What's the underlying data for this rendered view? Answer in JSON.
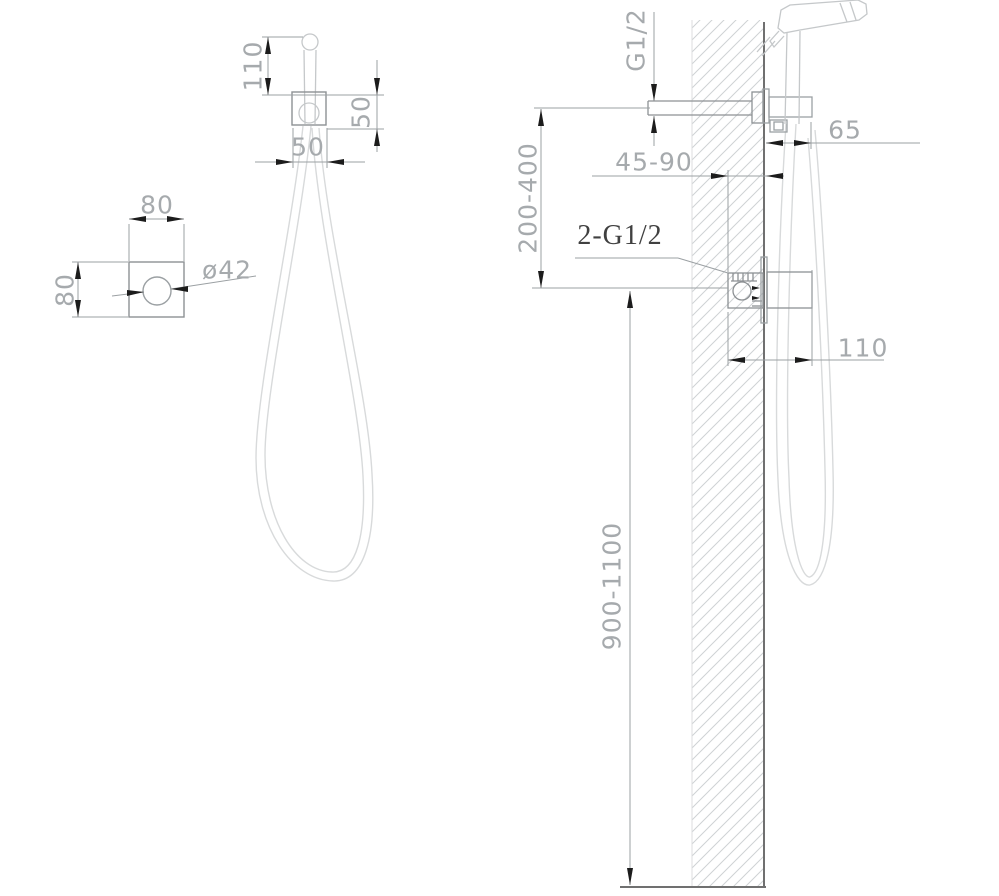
{
  "drawing": {
    "front_view": {
      "head_to_bracket": "110",
      "bracket_height": "50",
      "bracket_width": "50",
      "plate_width": "80",
      "plate_height": "80",
      "hole_diameter": "ø42"
    },
    "side_view": {
      "outlet_thread": "G1/2",
      "holder_depth": "65",
      "embed_depth_range": "45-90",
      "outlet_to_valve_range": "200-400",
      "connection_thread": "2-G1/2",
      "valve_depth": "110",
      "mount_height_range": "900-1100"
    },
    "colors": {
      "dimension_text": "#a6aaad",
      "annotation_text": "#404040",
      "dimension_line": "#9ba0a3",
      "object_line": "#8d9194",
      "light_line": "#c5c8ca",
      "hose_line": "#d8dadb",
      "wall_line": "#707070",
      "arrow": "#1c1c1c",
      "hatch": "#cfd2d4"
    }
  }
}
